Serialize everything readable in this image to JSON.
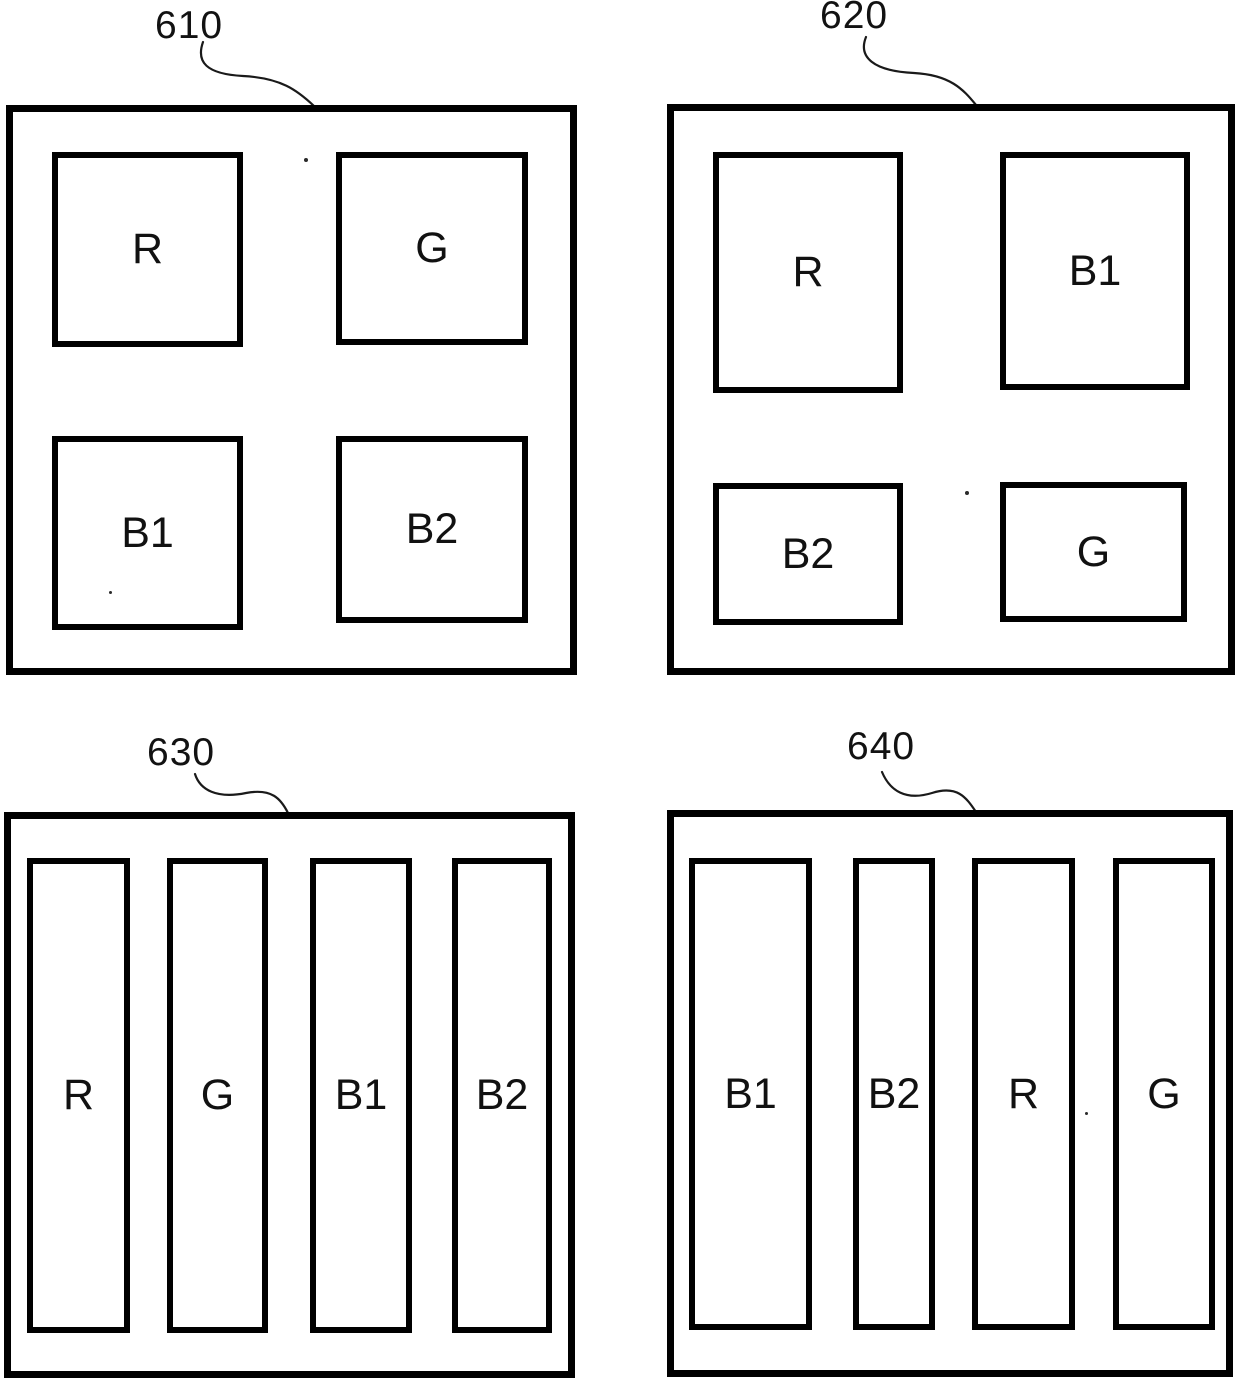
{
  "colors": {
    "ink": "#000000",
    "background": "#ffffff"
  },
  "panels": [
    {
      "ref_label": "610",
      "layout": "grid-2x2",
      "cells": [
        {
          "label": "R"
        },
        {
          "label": "G"
        },
        {
          "label": "B1"
        },
        {
          "label": "B2"
        }
      ]
    },
    {
      "ref_label": "620",
      "layout": "grid-2x2",
      "cells": [
        {
          "label": "R"
        },
        {
          "label": "B1"
        },
        {
          "label": "B2"
        },
        {
          "label": "G"
        }
      ]
    },
    {
      "ref_label": "630",
      "layout": "vertical-bars",
      "cells": [
        {
          "label": "R"
        },
        {
          "label": "G"
        },
        {
          "label": "B1"
        },
        {
          "label": "B2"
        }
      ]
    },
    {
      "ref_label": "640",
      "layout": "vertical-bars",
      "cells": [
        {
          "label": "B1"
        },
        {
          "label": "B2"
        },
        {
          "label": "R"
        },
        {
          "label": "G"
        }
      ]
    }
  ]
}
